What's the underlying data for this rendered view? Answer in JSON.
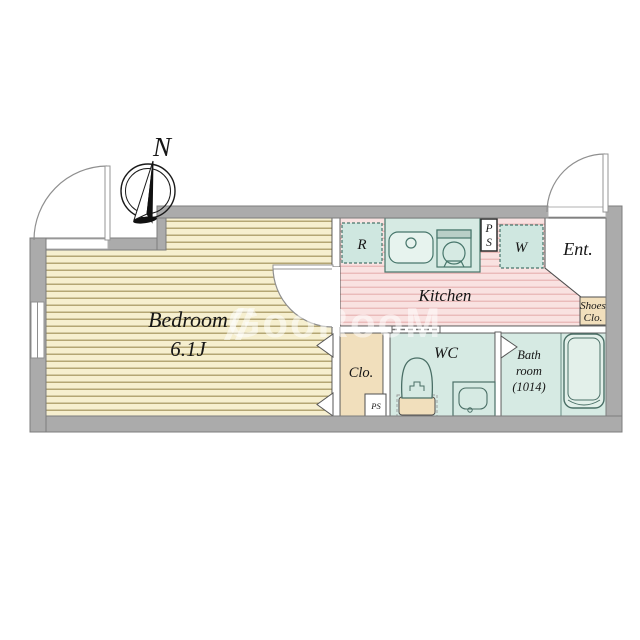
{
  "compass": {
    "north": "N"
  },
  "watermark": {
    "text": "GooRooM"
  },
  "rooms": {
    "bedroom": {
      "name": "Bedroom",
      "size": "6.1J"
    },
    "kitchen": {
      "name": "Kitchen"
    },
    "entrance": {
      "name": "Ent."
    },
    "shoes_closet": {
      "line1": "Shoes",
      "line2": "Clo."
    },
    "closet": {
      "name": "Clo."
    },
    "wc": {
      "name": "WC"
    },
    "bathroom": {
      "line1": "Bath",
      "line2": "room",
      "line3": "(1014)"
    }
  },
  "labels": {
    "refrigerator": "R",
    "washer": "W",
    "pipe_space_line1": "P",
    "pipe_space_line2": "S",
    "pipe_space_closet": "PS"
  },
  "colors": {
    "wall": "#ababab",
    "wood_floor": "#f6efcf",
    "wood_line": "#a3945e",
    "kitchen_floor": "#f9e2e1",
    "kitchen_line": "#e9b7b6",
    "unit_fill": "#d6eae3",
    "unit_light": "#e7f3ee",
    "unit_stroke": "#47766b",
    "closet_fill": "#f1dfbc",
    "outline": "#555555"
  }
}
